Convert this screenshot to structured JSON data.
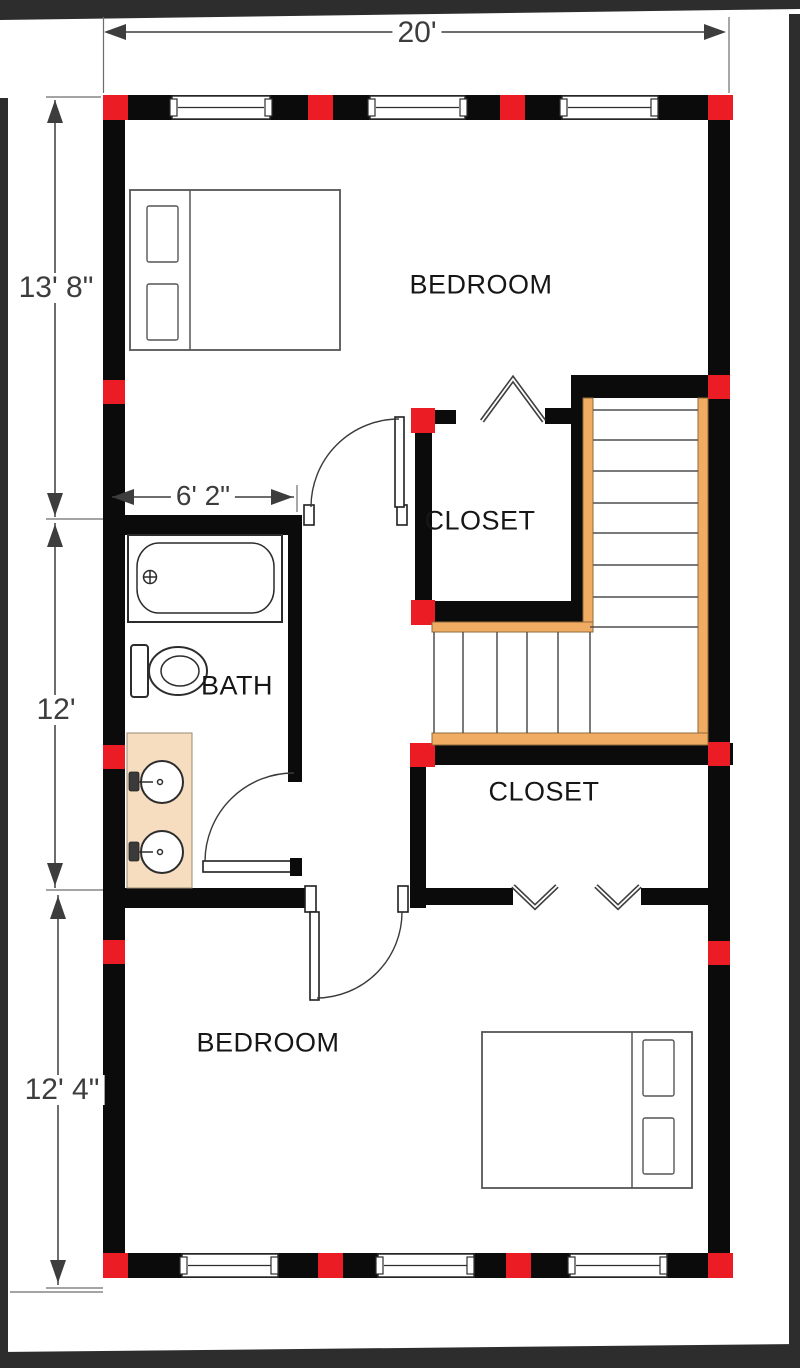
{
  "title": "Upper floor plan",
  "colors": {
    "wall": "#0b0b0b",
    "marker": "#ec1c24",
    "stair": "#f0ac62",
    "vanity": "#f6ddc0",
    "dim": "#3d3d3d",
    "frame": "#2d2d2d"
  },
  "rooms": {
    "bedroom_top": {
      "label": "BEDROOM"
    },
    "closet_top": {
      "label": "CLOSET"
    },
    "bath": {
      "label": "BATH"
    },
    "closet_bottom": {
      "label": "CLOSET"
    },
    "bedroom_bottom": {
      "label": "BEDROOM"
    }
  },
  "dimensions": {
    "overall_width": "20'",
    "bedroom_top_height": "13' 8\"",
    "bath_width": "6' 2\"",
    "bath_height": "12'",
    "bedroom_bottom_height": "12' 4\""
  }
}
